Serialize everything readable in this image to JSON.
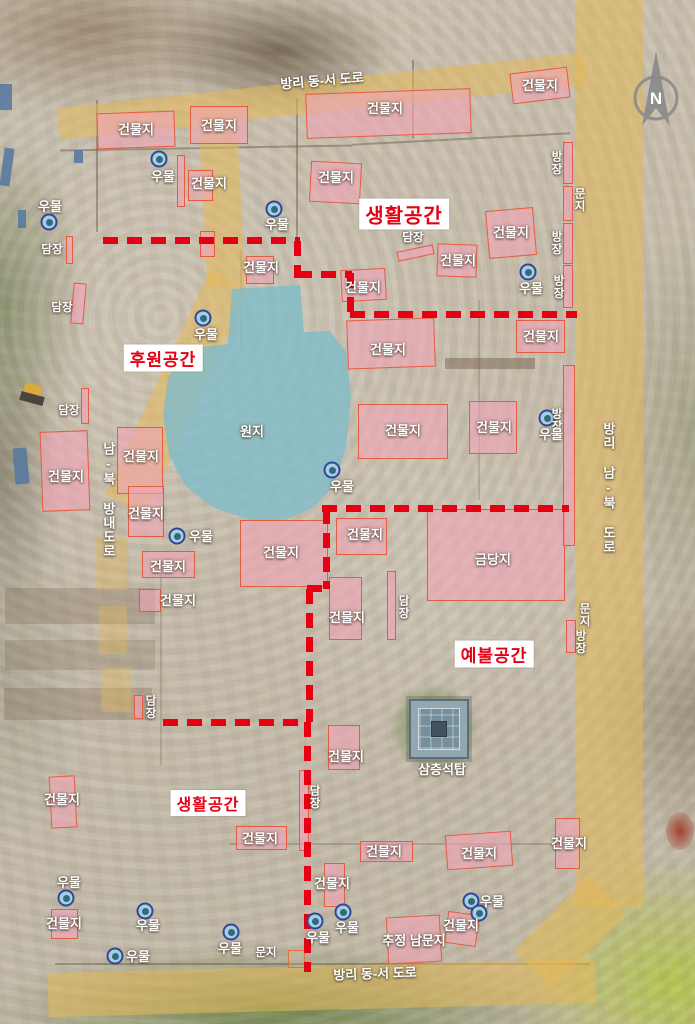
{
  "zones": [
    {
      "text": "생활공간",
      "cx": 404,
      "cy": 214,
      "fs": 20
    },
    {
      "text": "후원공간",
      "cx": 163,
      "cy": 358,
      "fs": 17
    },
    {
      "text": "예불공간",
      "cx": 494,
      "cy": 654,
      "fs": 17
    },
    {
      "text": "생활공간",
      "cx": 208,
      "cy": 803,
      "fs": 16
    }
  ],
  "road_labels": [
    {
      "text": "방리 동-서 도로",
      "cx": 322,
      "cy": 81,
      "v": false,
      "rot": -5
    },
    {
      "text": "방리 동-서 도로",
      "cx": 375,
      "cy": 974,
      "v": false,
      "rot": -2
    },
    {
      "text": "방리 남-북 도로",
      "cx": 608,
      "cy": 488,
      "v": true,
      "rot": 0
    },
    {
      "text": "남-북 방내도로",
      "cx": 108,
      "cy": 500,
      "v": true,
      "rot": 0
    }
  ],
  "buildings": [
    {
      "label": "건물지",
      "x": 97,
      "y": 112,
      "w": 78,
      "h": 36,
      "rot": -2,
      "lx": 136,
      "ly": 130
    },
    {
      "label": "건물지",
      "x": 190,
      "y": 106,
      "w": 58,
      "h": 38,
      "rot": 0,
      "lx": 219,
      "ly": 126
    },
    {
      "label": "건물지",
      "x": 306,
      "y": 91,
      "w": 165,
      "h": 45,
      "rot": -2,
      "lx": 385,
      "ly": 109
    },
    {
      "label": "건물지",
      "x": 511,
      "y": 70,
      "w": 58,
      "h": 31,
      "rot": -7,
      "lx": 540,
      "ly": 86
    },
    {
      "label": "건물지",
      "x": 188,
      "y": 170,
      "w": 25,
      "h": 31,
      "rot": 0,
      "lx": 209,
      "ly": 184
    },
    {
      "label": "건물지",
      "x": 310,
      "y": 162,
      "w": 51,
      "h": 41,
      "rot": 3,
      "lx": 336,
      "ly": 178
    },
    {
      "label": "건물지",
      "x": 487,
      "y": 209,
      "w": 48,
      "h": 48,
      "rot": -5,
      "lx": 511,
      "ly": 233
    },
    {
      "label": "건물지",
      "x": 437,
      "y": 244,
      "w": 40,
      "h": 33,
      "rot": 2,
      "lx": 458,
      "ly": 261
    },
    {
      "label": "건물지",
      "x": 246,
      "y": 256,
      "w": 28,
      "h": 28,
      "rot": 0,
      "lx": 261,
      "ly": 268
    },
    {
      "label": "건물지",
      "x": 341,
      "y": 269,
      "w": 45,
      "h": 32,
      "rot": -3,
      "lx": 363,
      "ly": 288
    },
    {
      "label": "건물지",
      "x": 347,
      "y": 319,
      "w": 88,
      "h": 49,
      "rot": -2,
      "lx": 388,
      "ly": 350
    },
    {
      "label": "건물지",
      "x": 516,
      "y": 320,
      "w": 49,
      "h": 33,
      "rot": 0,
      "lx": 541,
      "ly": 337
    },
    {
      "label": "건물지",
      "x": 358,
      "y": 404,
      "w": 90,
      "h": 55,
      "rot": 0,
      "lx": 403,
      "ly": 431
    },
    {
      "label": "건물지",
      "x": 469,
      "y": 401,
      "w": 48,
      "h": 53,
      "rot": 0,
      "lx": 494,
      "ly": 428
    },
    {
      "label": "건물지",
      "x": 41,
      "y": 431,
      "w": 48,
      "h": 80,
      "rot": -2,
      "lx": 66,
      "ly": 477
    },
    {
      "label": "건물지",
      "x": 117,
      "y": 427,
      "w": 46,
      "h": 67,
      "rot": 0,
      "lx": 141,
      "ly": 457
    },
    {
      "label": "건물지",
      "x": 128,
      "y": 486,
      "w": 36,
      "h": 51,
      "rot": 0,
      "lx": 146,
      "ly": 514
    },
    {
      "label": "건물지",
      "x": 142,
      "y": 551,
      "w": 53,
      "h": 27,
      "rot": 0,
      "lx": 168,
      "ly": 567
    },
    {
      "label": "건물지",
      "x": 139,
      "y": 589,
      "w": 22,
      "h": 23,
      "rot": 0,
      "lx": 178,
      "ly": 601
    },
    {
      "label": "건물지",
      "x": 240,
      "y": 520,
      "w": 88,
      "h": 67,
      "rot": 0,
      "lx": 281,
      "ly": 553
    },
    {
      "label": "건물지",
      "x": 336,
      "y": 518,
      "w": 51,
      "h": 37,
      "rot": 0,
      "lx": 365,
      "ly": 535
    },
    {
      "label": "금당지",
      "x": 427,
      "y": 509,
      "w": 138,
      "h": 92,
      "rot": 0,
      "lx": 493,
      "ly": 560
    },
    {
      "label": "건물지",
      "x": 329,
      "y": 577,
      "w": 33,
      "h": 63,
      "rot": 0,
      "lx": 347,
      "ly": 618
    },
    {
      "label": "건물지",
      "x": 328,
      "y": 725,
      "w": 32,
      "h": 45,
      "rot": 0,
      "lx": 346,
      "ly": 757
    },
    {
      "label": "건물지",
      "x": 50,
      "y": 776,
      "w": 26,
      "h": 52,
      "rot": -3,
      "lx": 62,
      "ly": 800
    },
    {
      "label": "건물지",
      "x": 236,
      "y": 826,
      "w": 51,
      "h": 24,
      "rot": 0,
      "lx": 260,
      "ly": 839
    },
    {
      "label": "건물지",
      "x": 51,
      "y": 909,
      "w": 27,
      "h": 30,
      "rot": 0,
      "lx": 64,
      "ly": 924
    },
    {
      "label": "건물지",
      "x": 324,
      "y": 863,
      "w": 21,
      "h": 44,
      "rot": 0,
      "lx": 332,
      "ly": 884
    },
    {
      "label": "추정 남문지",
      "x": 387,
      "y": 916,
      "w": 54,
      "h": 47,
      "rot": -3,
      "lx": 414,
      "ly": 941
    },
    {
      "label": "건물지",
      "x": 446,
      "y": 913,
      "w": 32,
      "h": 32,
      "rot": 8,
      "lx": 461,
      "ly": 926
    },
    {
      "label": "건물지",
      "x": 360,
      "y": 841,
      "w": 53,
      "h": 21,
      "rot": 0,
      "lx": 384,
      "ly": 852
    },
    {
      "label": "건물지",
      "x": 446,
      "y": 833,
      "w": 66,
      "h": 35,
      "rot": -4,
      "lx": 479,
      "ly": 854
    },
    {
      "label": "건물지",
      "x": 555,
      "y": 818,
      "w": 25,
      "h": 51,
      "rot": 0,
      "lx": 569,
      "ly": 844
    }
  ],
  "walls": [
    {
      "label": "담장",
      "x": 66,
      "y": 236,
      "w": 7,
      "h": 28,
      "rot": 0,
      "lx": 52,
      "ly": 250,
      "v": false
    },
    {
      "label": "담장",
      "x": 72,
      "y": 283,
      "w": 13,
      "h": 41,
      "rot": 5,
      "lx": 62,
      "ly": 308,
      "v": false
    },
    {
      "label": "담장",
      "x": 81,
      "y": 388,
      "w": 8,
      "h": 36,
      "rot": 0,
      "lx": 69,
      "ly": 411,
      "v": false
    },
    {
      "label": null,
      "x": 177,
      "y": 155,
      "w": 8,
      "h": 52,
      "rot": 0,
      "lx": 0,
      "ly": 0,
      "v": false
    },
    {
      "label": null,
      "x": 200,
      "y": 231,
      "w": 15,
      "h": 26,
      "rot": 0,
      "lx": 0,
      "ly": 0,
      "v": false
    },
    {
      "label": "담장",
      "x": 397,
      "y": 248,
      "w": 37,
      "h": 10,
      "rot": -12,
      "lx": 413,
      "ly": 238,
      "v": false
    },
    {
      "label": "담장",
      "x": 387,
      "y": 571,
      "w": 9,
      "h": 69,
      "rot": 0,
      "lx": 403,
      "ly": 607,
      "v": true
    },
    {
      "label": "담장",
      "x": 134,
      "y": 695,
      "w": 9,
      "h": 24,
      "rot": 0,
      "lx": 150,
      "ly": 707,
      "v": true
    },
    {
      "label": "담장",
      "x": 299,
      "y": 770,
      "w": 10,
      "h": 81,
      "rot": 0,
      "lx": 314,
      "ly": 797,
      "v": true
    },
    {
      "label": "방장",
      "x": 563,
      "y": 142,
      "w": 10,
      "h": 42,
      "rot": 0,
      "lx": 556,
      "ly": 163,
      "v": true
    },
    {
      "label": null,
      "x": 563,
      "y": 186,
      "w": 10,
      "h": 35,
      "rot": 0,
      "lx": 0,
      "ly": 0,
      "v": false
    },
    {
      "label": "방장",
      "x": 563,
      "y": 223,
      "w": 10,
      "h": 41,
      "rot": 0,
      "lx": 556,
      "ly": 243,
      "v": true
    },
    {
      "label": "방장",
      "x": 563,
      "y": 265,
      "w": 10,
      "h": 43,
      "rot": 0,
      "lx": 558,
      "ly": 287,
      "v": true
    },
    {
      "label": "방장",
      "x": 563,
      "y": 365,
      "w": 12,
      "h": 181,
      "rot": 0,
      "lx": 556,
      "ly": 420,
      "v": true
    },
    {
      "label": "방장",
      "x": 566,
      "y": 620,
      "w": 10,
      "h": 33,
      "rot": 0,
      "lx": 580,
      "ly": 642,
      "v": true
    }
  ],
  "gates": [
    {
      "label": "문지",
      "lx": 579,
      "ly": 200,
      "v": true,
      "box": null
    },
    {
      "label": "문지",
      "lx": 584,
      "ly": 615,
      "v": true,
      "box": null
    },
    {
      "label": "문지",
      "lx": 266,
      "ly": 953,
      "v": false,
      "box": [
        288,
        950,
        17,
        18
      ]
    }
  ],
  "wells": [
    {
      "cx": 159,
      "cy": 159,
      "label": "우물",
      "lx": 163,
      "ly": 177
    },
    {
      "cx": 274,
      "cy": 209,
      "label": "우물",
      "lx": 277,
      "ly": 225
    },
    {
      "cx": 49,
      "cy": 222,
      "label": "우물",
      "lx": 50,
      "ly": 207
    },
    {
      "cx": 528,
      "cy": 272,
      "label": "우물",
      "lx": 531,
      "ly": 289
    },
    {
      "cx": 203,
      "cy": 318,
      "label": "우물",
      "lx": 206,
      "ly": 335
    },
    {
      "cx": 332,
      "cy": 470,
      "label": "우물",
      "lx": 342,
      "ly": 487
    },
    {
      "cx": 547,
      "cy": 418,
      "label": "우물",
      "lx": 551,
      "ly": 435
    },
    {
      "cx": 177,
      "cy": 536,
      "label": "우물",
      "lx": 201,
      "ly": 537
    },
    {
      "cx": 66,
      "cy": 898,
      "label": "우물",
      "lx": 69,
      "ly": 883
    },
    {
      "cx": 145,
      "cy": 911,
      "label": "우물",
      "lx": 148,
      "ly": 926
    },
    {
      "cx": 115,
      "cy": 956,
      "label": "우물",
      "lx": 138,
      "ly": 957
    },
    {
      "cx": 231,
      "cy": 932,
      "label": "우물",
      "lx": 230,
      "ly": 949
    },
    {
      "cx": 315,
      "cy": 921,
      "label": "우물",
      "lx": 318,
      "ly": 938
    },
    {
      "cx": 343,
      "cy": 912,
      "label": "우물",
      "lx": 347,
      "ly": 928
    },
    {
      "cx": 471,
      "cy": 901,
      "label": "우물",
      "lx": 492,
      "ly": 902
    },
    {
      "cx": 479,
      "cy": 913,
      "label": null,
      "lx": 0,
      "ly": 0
    }
  ],
  "pond": {
    "label": "원지",
    "lx": 252,
    "ly": 432,
    "clip": "232px 289px,300px 285px,304px 332px,330px 331px,346px 352px,351px 398px,346px 448px,333px 487px,312px 508px,286px 520px,251px 520px,214px 508px,186px 487px,169px 455px,163px 415px,168px 378px,182px 357px,204px 347px,228px 344px"
  },
  "pagoda": {
    "label": "삼층석탑",
    "lx": 442,
    "ly": 770
  },
  "compass": {
    "label": "N"
  },
  "boundaries": [
    {
      "x": 103,
      "y": 237,
      "len": 197,
      "o": "h"
    },
    {
      "x": 294,
      "y": 241,
      "len": 37,
      "o": "v"
    },
    {
      "x": 297,
      "y": 271,
      "len": 55,
      "o": "h"
    },
    {
      "x": 347,
      "y": 273,
      "len": 43,
      "o": "v"
    },
    {
      "x": 350,
      "y": 311,
      "len": 227,
      "o": "h"
    },
    {
      "x": 322,
      "y": 505,
      "len": 247,
      "o": "h"
    },
    {
      "x": 323,
      "y": 509,
      "len": 80,
      "o": "v"
    },
    {
      "x": 307,
      "y": 585,
      "len": 22,
      "o": "h"
    },
    {
      "x": 306,
      "y": 589,
      "len": 133,
      "o": "v"
    },
    {
      "x": 163,
      "y": 719,
      "len": 146,
      "o": "h"
    },
    {
      "x": 304,
      "y": 722,
      "len": 250,
      "o": "v"
    }
  ],
  "palette": {
    "building_fill": "rgba(241,163,182,0.6)",
    "building_border": "#e4583a",
    "boundary_red": "#e60012",
    "zone_text": "#e60012",
    "road_fill": "#e3b858",
    "pond_fill": "#80bcc9",
    "well_ring": "#31479a",
    "label_white": "#ffffff"
  }
}
